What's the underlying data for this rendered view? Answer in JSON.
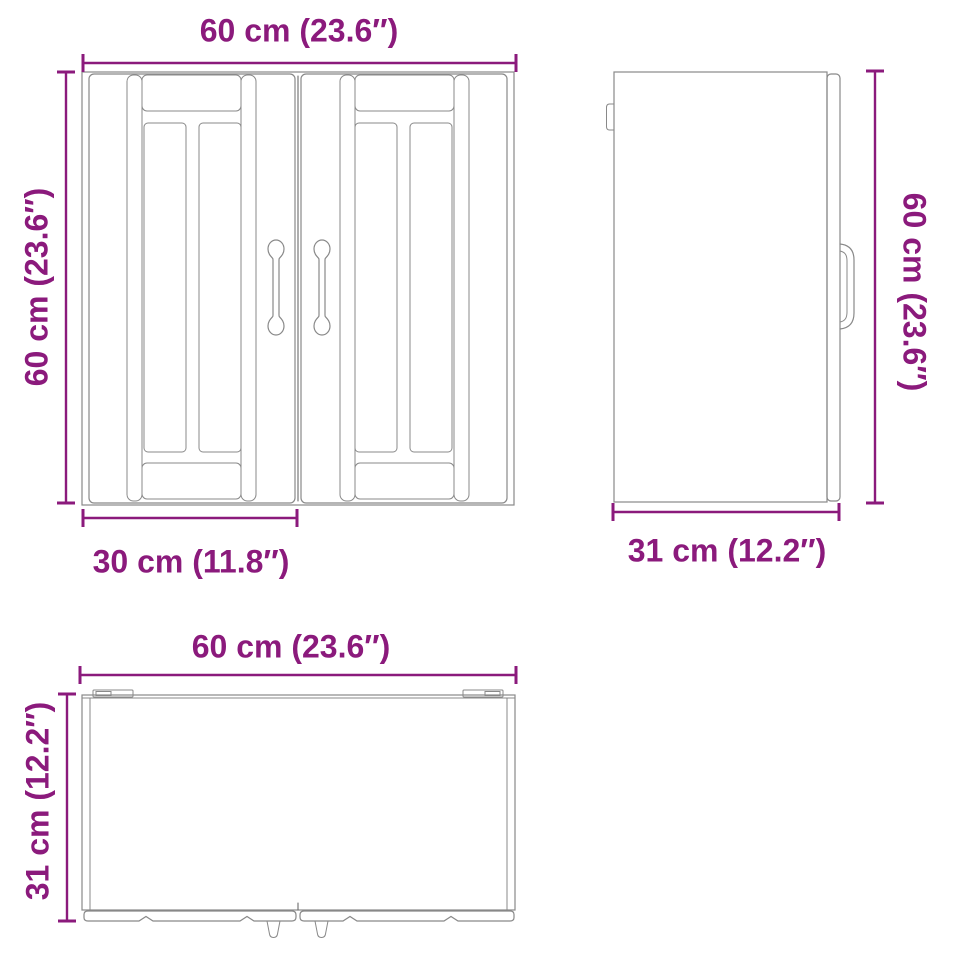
{
  "colors": {
    "dimension": "#8b1a7c",
    "outline": "#898989"
  },
  "front_view": {
    "width_label": "60 cm (23.6″)",
    "height_label": "60 cm (23.6″)",
    "door_width_label": "30 cm (11.8″)"
  },
  "side_view": {
    "height_label": "60 cm (23.6″)",
    "depth_label": "31 cm (12.2″)"
  },
  "top_view": {
    "width_label": "60 cm (23.6″)",
    "depth_label": "31 cm (12.2″)"
  }
}
